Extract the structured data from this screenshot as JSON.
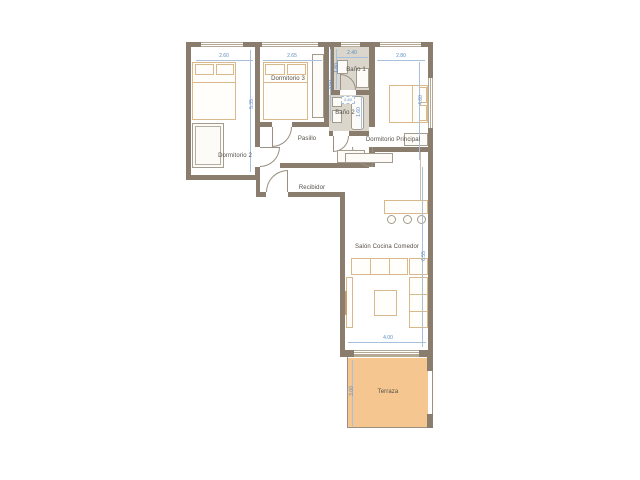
{
  "plan_title": "Apartment floor plan",
  "rooms": {
    "dormitorio2": {
      "label": "Dormitorio 2",
      "width": "2.60",
      "height": "5.35"
    },
    "dormitorio3": {
      "label": "Dormitorio 3",
      "width": "2.65",
      "height": "3.50"
    },
    "bano1": {
      "label": "Baño 1",
      "width": "2.40",
      "height": "1.80"
    },
    "bano2": {
      "label": "Baño 2",
      "width": "2.40",
      "height": "1.60"
    },
    "dormitorio_principal": {
      "label": "Dormitorio Principal",
      "width": "2.80",
      "height": "4.60"
    },
    "pasillo": {
      "label": "Pasillo"
    },
    "recibidor": {
      "label": "Recibidor"
    },
    "salon": {
      "label": "Salón Cocina Comedor",
      "width": "4.00",
      "height": "6.55"
    },
    "terraza": {
      "label": "Terraza",
      "depth": "3.00"
    }
  },
  "colors": {
    "wall": "#8b7d6d",
    "terrace_fill": "#f5c68f",
    "dimension_text": "#5e8bc0",
    "dimension_line": "#a9c0dc",
    "room_label_text": "#55504a",
    "furniture_outline": "#d9b98c",
    "fixture_outline": "#a39b8d",
    "bath_floor": "#dbd6cc"
  }
}
